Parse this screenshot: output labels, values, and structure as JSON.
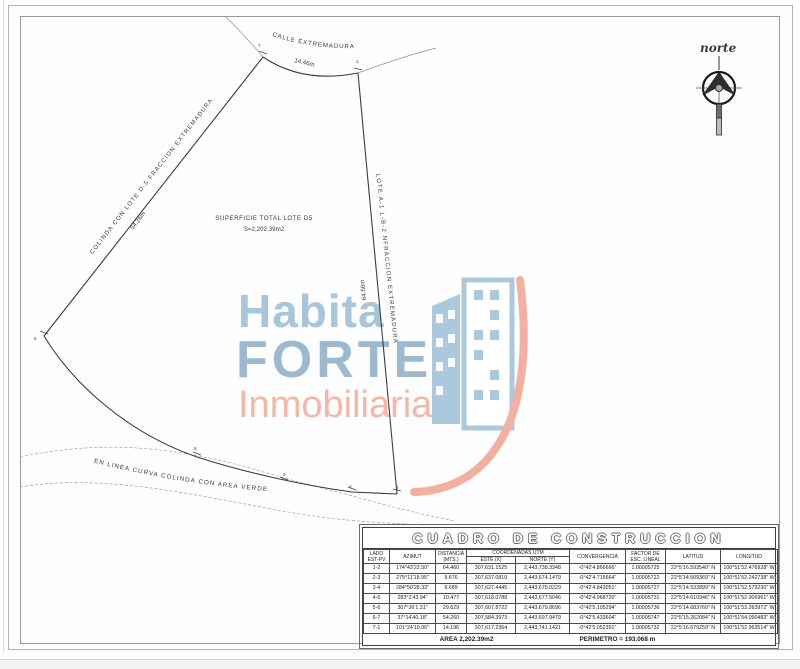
{
  "drawing": {
    "street_name": "CALLE EXTREMADURA",
    "street_length": "14.46m",
    "west_boundary": "COLINDA CON LOTE D-5 FRACCION EXTREMADURA",
    "west_length": "54.26m",
    "east_boundary": "LOTE A-1 L-B-2 NFRACCION EXTREMADURA",
    "east_length": "64.56m",
    "south_boundary": "EN LINEA CURVA COLINDA CON AREA VERDE",
    "surface_line1": "SUPERFICIE TOTAL LOTE D5",
    "surface_line2": "S=2,202.39m2",
    "north_label": "norte",
    "vertices": {
      "v1": "1",
      "v2": "2",
      "v3": "3",
      "v4": "4",
      "v5": "5",
      "v6": "6",
      "v7": "7"
    }
  },
  "watermark": {
    "word1": "Habita",
    "word2": "FORTE",
    "word3": "Inmobiliaria",
    "colors": {
      "blue": "#a7c6db",
      "blue_dark": "#9db9cf",
      "salmon": "#f5b6a6"
    }
  },
  "construction_table": {
    "title": "CUADRO DE CONSTRUCCION",
    "headers": {
      "lado1": "LADO",
      "lado2": "EST-PV",
      "azimut": "AZIMUT",
      "dist1": "DISTANCIA",
      "dist2": "(MTS.)",
      "coord": "COORDENADAS UTM",
      "este": "ESTE (X)",
      "norte": "NORTE (Y)",
      "convergencia": "CONVERGENCIA",
      "factor1": "FACTOR DE",
      "factor2": "ESC. LINEAL",
      "latitud": "LATITUD",
      "longitud": "LONGITUD"
    },
    "rows": [
      {
        "lado": "1-2",
        "azimut": "174°43'22.50\"",
        "distancia": "64.460",
        "este": "307,631.1525",
        "norte": "2,443,738.3348",
        "convergencia": "-0°42'4.866666\"",
        "factor": "1.00005725",
        "latitud": "22°5'16.593540\" N",
        "longitud": "100°51'52.476928\" W"
      },
      {
        "lado": "2-3",
        "azimut": "275°11'18.95\"",
        "distancia": "9.676",
        "este": "307,637.0810",
        "norte": "2,443,674.1479",
        "convergencia": "-0°42'4.715664\"",
        "factor": "1.00005722",
        "latitud": "22°5'14.509369\" N",
        "longitud": "100°51'52.242738\" W"
      },
      {
        "lado": "3-4",
        "azimut": "284°50'28.33\"",
        "distancia": "9.689",
        "este": "307,627.4445",
        "norte": "2,443,675.0229",
        "convergencia": "-0°42'4.843051\"",
        "factor": "1.00005727",
        "latitud": "22°5'14.533899\" N",
        "longitud": "100°51'52.579230\" W"
      },
      {
        "lado": "4-5",
        "azimut": "283°2'43.94\"",
        "distancia": "10.477",
        "este": "307,618.0788",
        "norte": "2,443,677.5046",
        "convergencia": "-0°42'4.968720\"",
        "factor": "1.00005731",
        "latitud": "22°5'14.610946\" N",
        "longitud": "100°51'52.906961\" W"
      },
      {
        "lado": "5-6",
        "azimut": "307°36'1.31\"",
        "distancia": "29.629",
        "este": "307,607.8722",
        "norte": "2,443,679.8696",
        "convergencia": "-0°42'5.105294\"",
        "factor": "1.00005736",
        "latitud": "22°5'14.683760\" N",
        "longitud": "100°51'53.263972\" W"
      },
      {
        "lado": "6-7",
        "azimut": "37°14'40.18\"",
        "distancia": "54.260",
        "este": "307,584.3973",
        "norte": "2,443,697.9479",
        "convergencia": "-0°42'5.433604\"",
        "factor": "1.00005747",
        "latitud": "22°5'15.262084\" N",
        "longitud": "100°51'54.090483\" W"
      },
      {
        "lado": "7-1",
        "azimut": "101°24'19.06\"",
        "distancia": "14.196",
        "este": "307,617.2364",
        "norte": "2,443,741.1421",
        "convergencia": "-0°42'5.052391\"",
        "factor": "1.00005732",
        "latitud": "22°5'16.679259\" N",
        "longitud": "100°51'52.963514\" W"
      }
    ],
    "area": "AREA  2,202.39m2",
    "perimeter": "PERIMETRO = 193.068 m"
  }
}
